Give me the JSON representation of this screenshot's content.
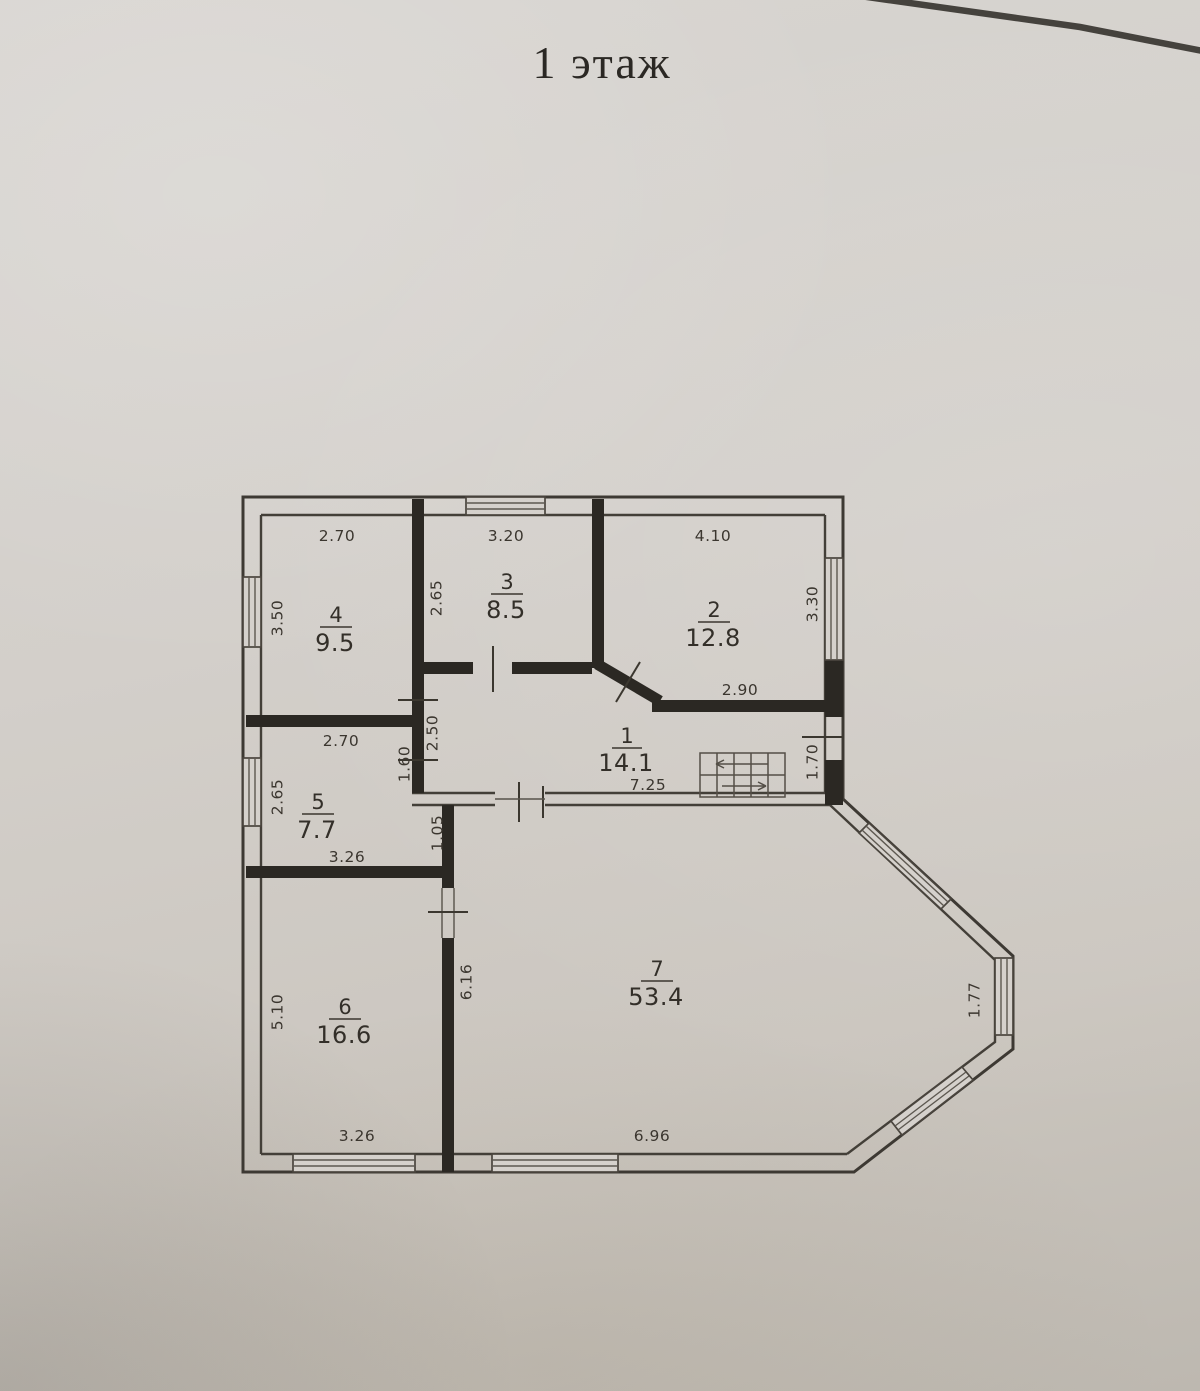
{
  "title": "1 этаж",
  "plan": {
    "rooms": {
      "r1": {
        "number": "1",
        "area": "14.1"
      },
      "r2": {
        "number": "2",
        "area": "12.8"
      },
      "r3": {
        "number": "3",
        "area": "8.5"
      },
      "r4": {
        "number": "4",
        "area": "9.5"
      },
      "r5": {
        "number": "5",
        "area": "7.7"
      },
      "r6": {
        "number": "6",
        "area": "16.6"
      },
      "r7": {
        "number": "7",
        "area": "53.4"
      }
    },
    "dims": {
      "r4_top": "2.70",
      "r3_top": "3.20",
      "r2_top": "4.10",
      "r4_left": "3.50",
      "r3_left": "2.65",
      "r2_right": "3.30",
      "r5_top": "2.70",
      "r1_left": "2.50",
      "r5_right": "1.60",
      "r5_left": "2.65",
      "r2_bottom": "2.90",
      "r1_bottom": "7.25",
      "r1_right": "1.70",
      "r5_bottom": "3.26",
      "gap_5_7": "1.05",
      "r6_left": "5.10",
      "r6_right": "6.16",
      "r6_bottom": "3.26",
      "r7_bottom": "6.96",
      "bay_right": "1.77"
    },
    "colors": {
      "paper": "#d3cfca",
      "ink": "#3a352e",
      "wall_fill": "#2b2823",
      "photo_edge": "#45423d"
    }
  }
}
